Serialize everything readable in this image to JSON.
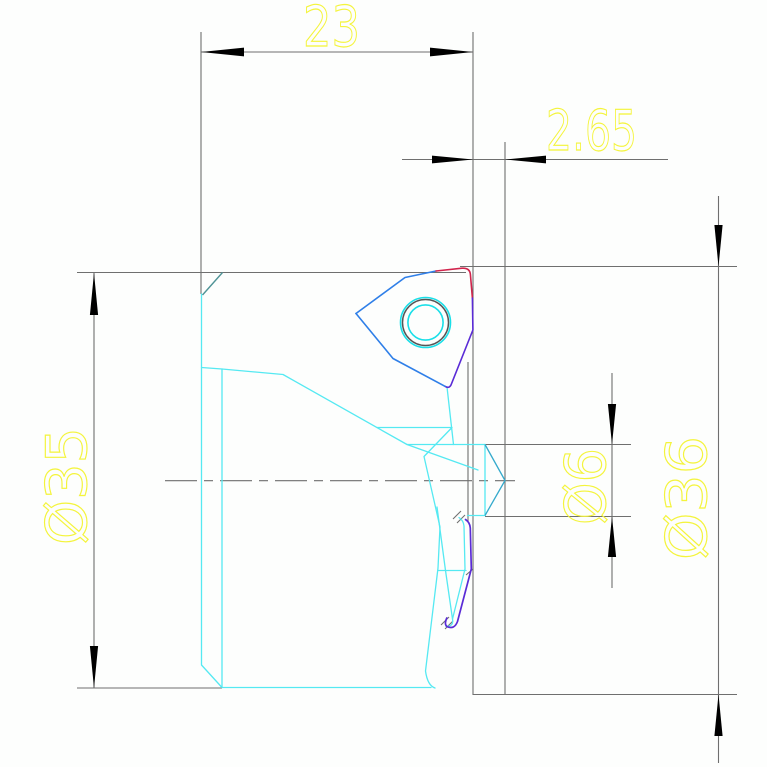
{
  "dimensions": {
    "width_23": {
      "label": "23"
    },
    "offset_2_65": {
      "label": "2.65"
    },
    "diameter_35": {
      "label": "Ø35"
    },
    "diameter_6": {
      "label": "Ø6"
    },
    "diameter_36": {
      "label": "Ø36"
    }
  },
  "colors": {
    "background": "#fdfefd",
    "dim_line": "#6f6f6f",
    "arrow": "#000000",
    "dim_text": "#f4f43c",
    "part": "#55e9f2",
    "part_bright": "#19dfe8",
    "hole_ring": "#555555",
    "insert_blue": "#2f7fe8",
    "insert_red": "#d1244c",
    "insert_purple": "#5a2bd6",
    "pocket_purple": "#5a2bd6",
    "chamfer": "#4f9396",
    "pilot_edge": "#35aacc",
    "centerline": "#6f6f6f"
  }
}
